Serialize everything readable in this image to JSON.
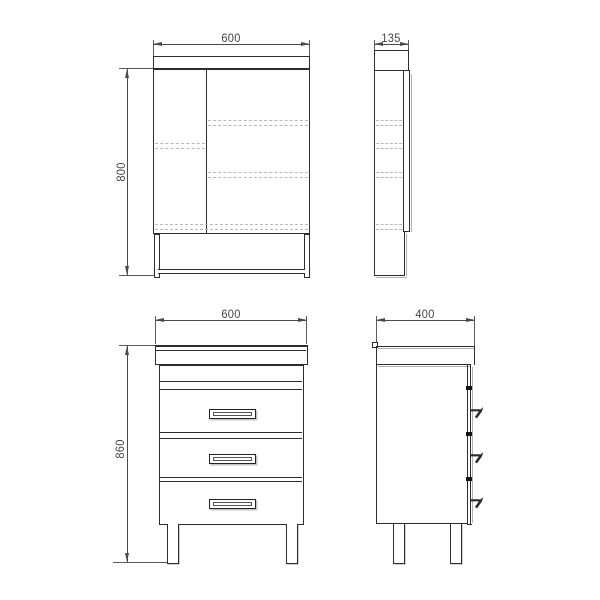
{
  "views": {
    "mirror_front": {
      "width": "600",
      "height": "800"
    },
    "mirror_side": {
      "depth": "135"
    },
    "vanity_front": {
      "width": "600",
      "height": "860"
    },
    "vanity_side": {
      "depth": "400"
    }
  },
  "colors": {
    "outline": "#2d2d2d",
    "dimension": "#4a4a4a",
    "hidden_line": "#b9b9b9",
    "shadow": "#b0b0b0",
    "background": "#ffffff"
  }
}
